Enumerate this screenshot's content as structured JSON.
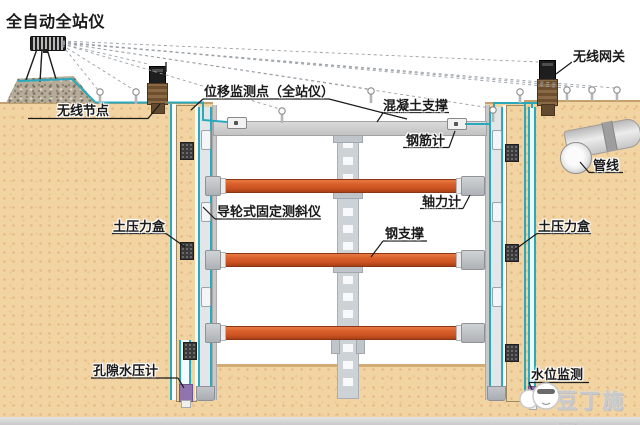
{
  "diagram": {
    "title_note": "基坑监测系统示意图",
    "labels": {
      "total_station": "全自动全站仪",
      "wireless_node": "无线节点",
      "displacement_point": "位移监测点（全站仪）",
      "concrete_support": "混凝土支撑",
      "rebar_meter": "钢筋计",
      "axial_force_meter": "轴力计",
      "fixed_inclinometer": "导轮式固定测斜仪",
      "steel_support": "钢支撑",
      "earth_pressure_box_left": "土压力盒",
      "earth_pressure_box_right": "土压力盒",
      "pore_water_pressure_gauge": "孔隙水压计",
      "water_level_monitoring": "水位监测",
      "wireless_gateway": "无线网关",
      "pipeline": "管线"
    },
    "watermark": "豆丁施工",
    "colors": {
      "ground_sand": "#f2d3a2",
      "cable_teal": "#2aa9bc",
      "steel_support_orange": "#d95f2a",
      "concrete_gray": "#c9c9c9",
      "sensor_box_dark": "#3a3a3a",
      "pore_sensor_purple": "#8f74ad",
      "watermark_gray": "#c9c9c9"
    }
  }
}
